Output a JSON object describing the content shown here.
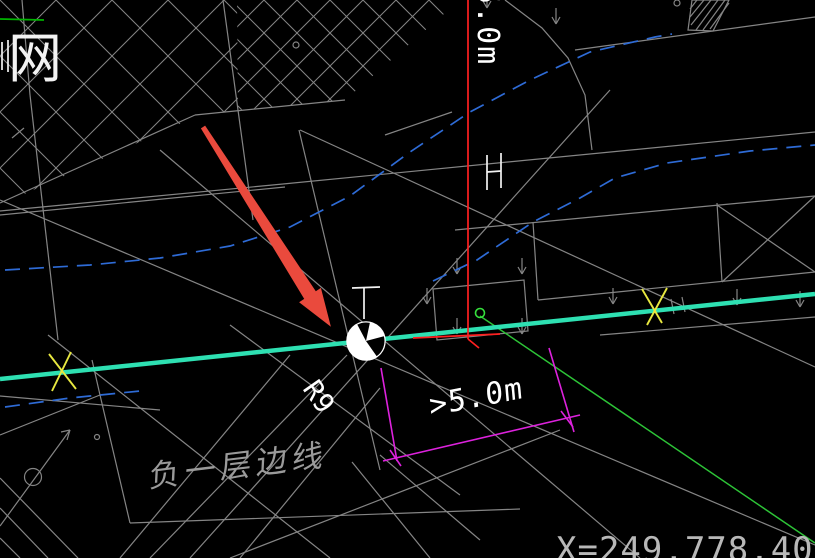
{
  "title": "CAD drawing viewport with annotation arrow",
  "labels": {
    "net_label": "网",
    "vertical_dim": "5.0m",
    "clearance_dim": ">5.0m",
    "radius_label": "R9",
    "basement_edge_label": "负一层边线",
    "coordinate_readout": "X=249,778.405"
  },
  "colors": {
    "background": "#000000",
    "construction_gray": "#858585",
    "symbol_white": "#f2f2f2",
    "boundary_cyan": "#2ee0b2",
    "reference_red": "#ff2020",
    "annotation_arrow_red": "#ea4a3d",
    "dimension_magenta": "#dd22dd",
    "utility_green": "#2dc437",
    "accent_green": "#35e03c",
    "topleft_green": "#00b400",
    "contour_blue": "#2e6bd6",
    "marker_yellow": "#e8e840"
  },
  "drawing": {
    "cyan_line": [
      0,
      379,
      815,
      294
    ],
    "gray_lines": [
      [
        0,
        211,
        283,
        184
      ],
      [
        0,
        215,
        285,
        187
      ],
      [
        283,
        184,
        815,
        132
      ],
      [
        0,
        203,
        195,
        115
      ],
      [
        195,
        115,
        345,
        100
      ],
      [
        22,
        0,
        30,
        95
      ],
      [
        30,
        95,
        58,
        340
      ],
      [
        48,
        335,
        330,
        558
      ],
      [
        0,
        396,
        160,
        410
      ],
      [
        92,
        360,
        100,
        395
      ],
      [
        100,
        395,
        130,
        523
      ],
      [
        130,
        523,
        520,
        509
      ],
      [
        120,
        558,
        290,
        355
      ],
      [
        240,
        558,
        380,
        388
      ],
      [
        150,
        558,
        347,
        355
      ],
      [
        230,
        325,
        460,
        495
      ],
      [
        230,
        558,
        560,
        430
      ],
      [
        190,
        558,
        610,
        90
      ],
      [
        160,
        150,
        640,
        558
      ],
      [
        0,
        200,
        815,
        545
      ],
      [
        300,
        130,
        815,
        367
      ],
      [
        299,
        130,
        380,
        470
      ],
      [
        223,
        0,
        253,
        220
      ],
      [
        455,
        230,
        815,
        196
      ],
      [
        533,
        222,
        538,
        300
      ],
      [
        538,
        300,
        815,
        272
      ],
      [
        717,
        203,
        722,
        282
      ],
      [
        717,
        205,
        815,
        272
      ],
      [
        815,
        196,
        722,
        282
      ],
      [
        600,
        335,
        815,
        317
      ],
      [
        575,
        50,
        815,
        17
      ],
      [
        385,
        135,
        452,
        112
      ],
      [
        0,
        435,
        100,
        395
      ],
      [
        0,
        478,
        78,
        558
      ],
      [
        0,
        508,
        48,
        558
      ],
      [
        0,
        538,
        20,
        558
      ],
      [
        352,
        462,
        430,
        558
      ],
      [
        380,
        455,
        480,
        540
      ],
      [
        12,
        138,
        24,
        128
      ],
      [
        0,
        526,
        70,
        430
      ],
      [
        70,
        430,
        61,
        432
      ],
      [
        70,
        430,
        67,
        440
      ],
      [
        697,
        0,
        690,
        9
      ],
      [
        704,
        0,
        690,
        17
      ],
      [
        711,
        0,
        691,
        25
      ],
      [
        718,
        0,
        696,
        30
      ],
      [
        725,
        0,
        703,
        30
      ],
      [
        729,
        3,
        710,
        29
      ],
      [
        671,
        299,
        674,
        314
      ],
      [
        682,
        297,
        685,
        312
      ]
    ],
    "gray_polygons": [
      [
        433,
        289,
        524,
        280,
        528,
        331,
        437,
        340
      ],
      [
        692,
        0,
        729,
        0,
        713,
        31,
        688,
        30
      ]
    ],
    "gray_arc": [
      505,
      0,
      542,
      28,
      568,
      58,
      585,
      95,
      592,
      150
    ],
    "gray_circles": [
      [
        296,
        45,
        3
      ],
      [
        677,
        3,
        3
      ],
      [
        97,
        437,
        2.5
      ],
      [
        33,
        477,
        8.5
      ]
    ],
    "down_arrows": [
      [
        457,
        258
      ],
      [
        522,
        258
      ],
      [
        427,
        288
      ],
      [
        457,
        318
      ],
      [
        522,
        318
      ],
      [
        613,
        288
      ],
      [
        737,
        289
      ],
      [
        800,
        291
      ],
      [
        487,
        -8
      ],
      [
        556,
        8
      ]
    ],
    "white_lines": [
      [
        352,
        288,
        380,
        287
      ],
      [
        364,
        288,
        364,
        319
      ],
      [
        487,
        155,
        487,
        190
      ],
      [
        501,
        153,
        501,
        188
      ],
      [
        487,
        172,
        501,
        171
      ],
      [
        2,
        42,
        2,
        70
      ],
      [
        8,
        40,
        8,
        72
      ]
    ],
    "blue_dashed": [
      [
        5,
        270,
        90,
        265,
        160,
        258,
        230,
        246,
        290,
        227,
        350,
        196,
        410,
        152,
        470,
        112,
        530,
        80,
        590,
        52,
        655,
        37,
        672,
        34
      ],
      [
        433,
        281,
        477,
        260,
        533,
        222,
        580,
        198,
        615,
        178,
        667,
        163,
        750,
        151,
        815,
        145
      ],
      [
        5,
        407,
        70,
        398,
        140,
        391
      ]
    ],
    "green_lines": [
      [
        0,
        19,
        44,
        20
      ],
      [
        480,
        316,
        815,
        543
      ]
    ],
    "green_circle": [
      480,
      313,
      4.5
    ],
    "red_lines": [
      [
        468,
        0,
        468,
        339
      ],
      [
        413,
        338,
        500,
        334
      ],
      [
        468,
        339,
        479,
        348
      ]
    ],
    "magenta_lines": [
      [
        381,
        368,
        397,
        461
      ],
      [
        549,
        348,
        574,
        432
      ],
      [
        383,
        461,
        580,
        415
      ],
      [
        390,
        450,
        401,
        466
      ],
      [
        561,
        411,
        573,
        427
      ]
    ],
    "yellow_lines": [
      [
        49,
        354,
        76,
        389
      ],
      [
        71,
        352,
        52,
        391
      ],
      [
        642,
        289,
        662,
        323
      ],
      [
        667,
        288,
        647,
        325
      ]
    ],
    "annotation_arrow_polygon": [
      205.1,
      125.6,
      315.8,
      291.2,
      320.9,
      287.9,
      330.9,
      326.7,
      299.1,
      302.2,
      304.2,
      298.9,
      200.9,
      128.4
    ],
    "survey_point": {
      "cx": 366,
      "cy": 341,
      "r": 19,
      "wedges": [
        [
          -118,
          -78
        ],
        [
          -15,
          55
        ]
      ]
    },
    "lattices": [
      {
        "id": "lat1",
        "spacing": 56,
        "clip": [
          0,
          0,
          237,
          0,
          238,
          110,
          195,
          117,
          0,
          205
        ]
      },
      {
        "id": "lat2",
        "spacing": 33,
        "clip": [
          237,
          0,
          460,
          0,
          345,
          100,
          238,
          110
        ]
      }
    ]
  }
}
